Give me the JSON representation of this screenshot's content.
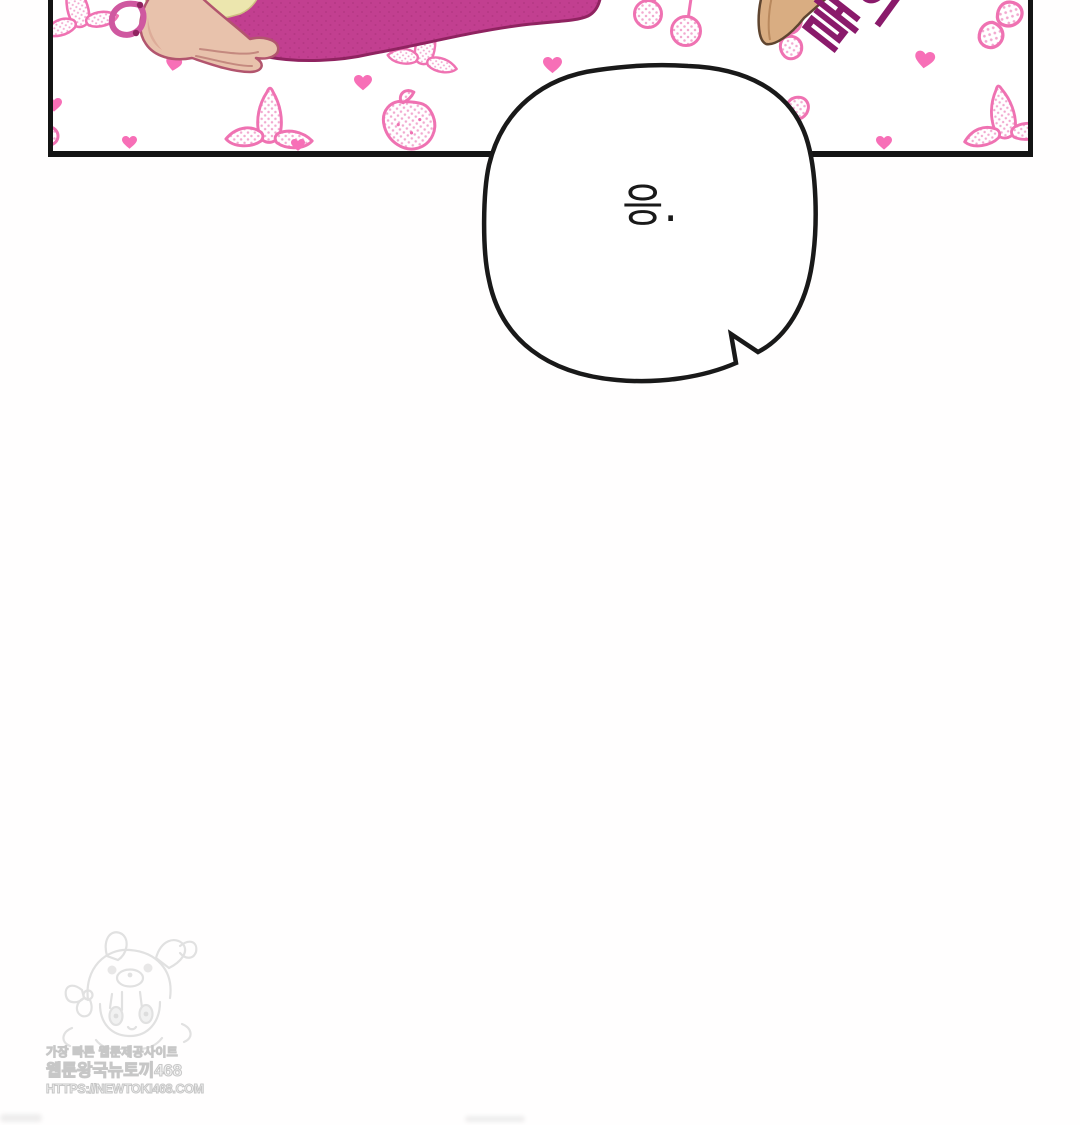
{
  "page": {
    "background": "#fffefe"
  },
  "panel": {
    "border_color": "#141414",
    "art": {
      "sleeve": "#c23f90",
      "sleeve_outline": "#8f2360",
      "hand": "#e8c2ac",
      "hand_outline": "#b2556e",
      "hair": "#ece6ae",
      "wedge": "#d9ad82",
      "pattern_pink": "#ef72b2",
      "heart_pink": "#f76fb7",
      "motifs": [
        "peeled-banana",
        "heart",
        "cherries",
        "strawberry",
        "banana-slice"
      ]
    },
    "sfx": {
      "char1": "놀",
      "char2": "이",
      "text": "놀이",
      "color": "#8a1a6b"
    }
  },
  "bubble": {
    "text": "응.",
    "outline": "#191919",
    "fill": "#ffffff"
  },
  "watermark": {
    "line1": "가장 빠른 웹툰제공사이트",
    "line2": "웹툰왕국뉴토끼468",
    "line3": "HTTPS://NEWTOKI468.COM"
  }
}
